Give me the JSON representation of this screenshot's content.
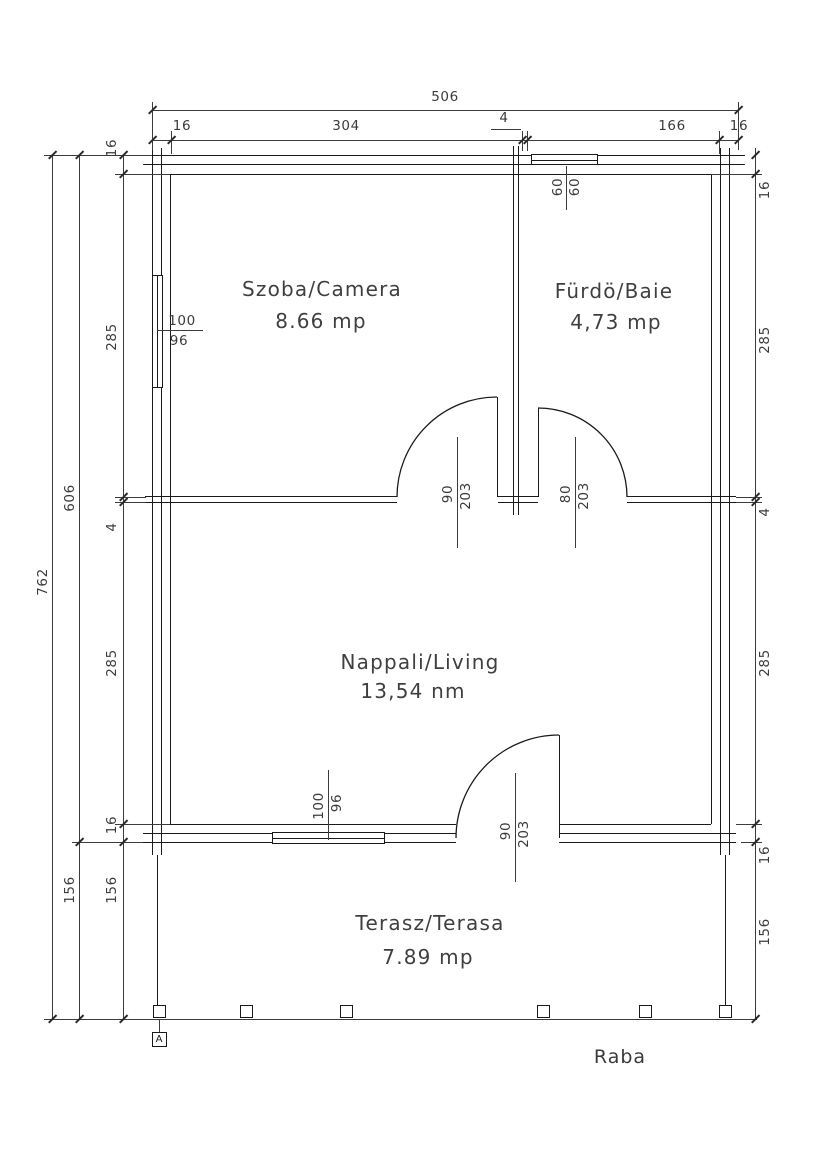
{
  "rooms": [
    {
      "name": "Szoba/Camera",
      "area": "8.66 mp"
    },
    {
      "name": "Fürdö/Baie",
      "area": "4,73 mp"
    },
    {
      "name": "Nappali/Living",
      "area": "13,54 nm"
    },
    {
      "name": "Terasz/Terasa",
      "area": "7.89 mp"
    }
  ],
  "dims": {
    "top_total": "506",
    "top_chain": [
      "16",
      "304",
      "4",
      "166",
      "16"
    ],
    "left_total": "762",
    "left_outer": [
      "606",
      "156"
    ],
    "left_chain": [
      "16",
      "285",
      "4",
      "285",
      "16",
      "156"
    ],
    "right_chain": [
      "16",
      "285",
      "4",
      "285",
      "16",
      "156"
    ]
  },
  "openings": {
    "window_top": {
      "w": "60",
      "h": "60"
    },
    "window_left": {
      "w": "100",
      "h": "96"
    },
    "window_bottom": {
      "w": "100",
      "h": "96"
    },
    "door_bedroom": {
      "w": "90",
      "h": "203"
    },
    "door_bath": {
      "w": "80",
      "h": "203"
    },
    "door_terrace": {
      "w": "90",
      "h": "203"
    }
  },
  "annotations": {
    "section_marker": "A",
    "signature": "Raba"
  },
  "colors": {
    "wall_line": "#1a1a1a",
    "dim_line": "#3c3c3c",
    "text": "#3b3b3b",
    "background": "#ffffff"
  }
}
